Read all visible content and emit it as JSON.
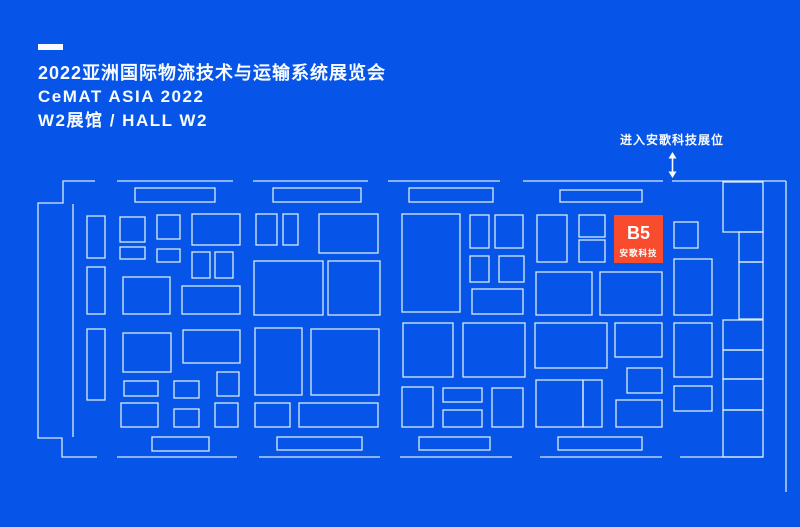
{
  "colors": {
    "background": "#0655E8",
    "line": "#D8ECF4",
    "text": "#F7FBFD",
    "highlight": "#F94B2D",
    "highlight_text": "#FFFFFF"
  },
  "header": {
    "title": "2022亚洲国际物流技术与运输系统展览会",
    "subtitle": "CeMAT ASIA 2022",
    "hall": "W2展馆 / HALL W2"
  },
  "annotation": {
    "label": "进入安歌科技展位"
  },
  "highlight_booth": {
    "id": "B5",
    "company": "安歌科技",
    "x": 614,
    "y": 215,
    "w": 49,
    "h": 48
  },
  "floorplan": {
    "width": 800,
    "height": 527,
    "booths": [
      [
        135,
        188,
        80,
        14
      ],
      [
        273,
        188,
        88,
        14
      ],
      [
        409,
        188,
        84,
        14
      ],
      [
        560,
        190,
        82,
        12
      ],
      [
        152,
        437,
        57,
        14
      ],
      [
        277,
        437,
        85,
        13
      ],
      [
        419,
        437,
        71,
        13
      ],
      [
        558,
        437,
        84,
        13
      ],
      [
        87,
        216,
        18,
        42
      ],
      [
        87,
        267,
        18,
        47
      ],
      [
        87,
        329,
        18,
        71
      ],
      [
        120,
        217,
        25,
        25
      ],
      [
        120,
        247,
        25,
        12
      ],
      [
        157,
        215,
        23,
        24
      ],
      [
        157,
        249,
        23,
        13
      ],
      [
        192,
        214,
        48,
        31
      ],
      [
        192,
        252,
        18,
        26
      ],
      [
        215,
        252,
        18,
        26
      ],
      [
        123,
        277,
        47,
        37
      ],
      [
        182,
        286,
        58,
        28
      ],
      [
        123,
        333,
        48,
        39
      ],
      [
        183,
        330,
        57,
        33
      ],
      [
        124,
        381,
        34,
        15
      ],
      [
        174,
        381,
        25,
        17
      ],
      [
        217,
        372,
        22,
        24
      ],
      [
        121,
        403,
        37,
        24
      ],
      [
        174,
        409,
        25,
        18
      ],
      [
        215,
        403,
        23,
        24
      ],
      [
        256,
        214,
        21,
        31
      ],
      [
        283,
        214,
        15,
        31
      ],
      [
        319,
        214,
        59,
        39
      ],
      [
        254,
        261,
        69,
        54
      ],
      [
        328,
        261,
        52,
        54
      ],
      [
        255,
        328,
        47,
        67
      ],
      [
        311,
        329,
        68,
        66
      ],
      [
        255,
        403,
        35,
        24
      ],
      [
        299,
        403,
        79,
        24
      ],
      [
        402,
        214,
        58,
        98
      ],
      [
        470,
        215,
        19,
        33
      ],
      [
        495,
        215,
        28,
        33
      ],
      [
        470,
        256,
        19,
        26
      ],
      [
        499,
        256,
        25,
        26
      ],
      [
        472,
        289,
        51,
        25
      ],
      [
        403,
        323,
        50,
        54
      ],
      [
        463,
        323,
        62,
        54
      ],
      [
        402,
        387,
        31,
        40
      ],
      [
        443,
        388,
        39,
        14
      ],
      [
        443,
        410,
        39,
        17
      ],
      [
        492,
        388,
        31,
        39
      ],
      [
        537,
        215,
        30,
        47
      ],
      [
        579,
        215,
        26,
        22
      ],
      [
        579,
        240,
        26,
        22
      ],
      [
        536,
        272,
        56,
        43
      ],
      [
        600,
        272,
        62,
        43
      ],
      [
        535,
        323,
        72,
        45
      ],
      [
        615,
        323,
        47,
        34
      ],
      [
        627,
        368,
        35,
        25
      ],
      [
        536,
        380,
        47,
        47
      ],
      [
        583,
        380,
        19,
        47
      ],
      [
        616,
        400,
        46,
        27
      ],
      [
        674,
        222,
        24,
        26
      ],
      [
        674,
        259,
        38,
        56
      ],
      [
        674,
        323,
        38,
        54
      ],
      [
        674,
        386,
        38,
        25
      ],
      [
        723,
        182,
        40,
        50
      ],
      [
        739,
        232,
        24,
        30
      ],
      [
        739,
        262,
        24,
        57
      ],
      [
        723,
        320,
        40,
        30
      ],
      [
        723,
        350,
        40,
        29
      ],
      [
        723,
        379,
        40,
        31
      ],
      [
        723,
        410,
        40,
        47
      ]
    ],
    "walls": [
      [
        [
          95,
          181
        ],
        [
          63,
          181
        ],
        [
          63,
          203
        ],
        [
          38,
          203
        ],
        [
          38,
          438
        ],
        [
          62,
          438
        ],
        [
          62,
          457
        ],
        [
          97,
          457
        ]
      ],
      [
        [
          73,
          204
        ],
        [
          73,
          437
        ]
      ],
      [
        [
          117,
          181
        ],
        [
          233,
          181
        ]
      ],
      [
        [
          253,
          181
        ],
        [
          368,
          181
        ]
      ],
      [
        [
          388,
          181
        ],
        [
          500,
          181
        ]
      ],
      [
        [
          523,
          181
        ],
        [
          663,
          181
        ]
      ],
      [
        [
          672,
          181
        ],
        [
          786,
          181
        ]
      ],
      [
        [
          786,
          181
        ],
        [
          786,
          492
        ]
      ],
      [
        [
          117,
          457
        ],
        [
          237,
          457
        ]
      ],
      [
        [
          259,
          457
        ],
        [
          380,
          457
        ]
      ],
      [
        [
          400,
          457
        ],
        [
          512,
          457
        ]
      ],
      [
        [
          540,
          457
        ],
        [
          662,
          457
        ]
      ],
      [
        [
          680,
          457
        ],
        [
          763,
          457
        ]
      ]
    ]
  }
}
